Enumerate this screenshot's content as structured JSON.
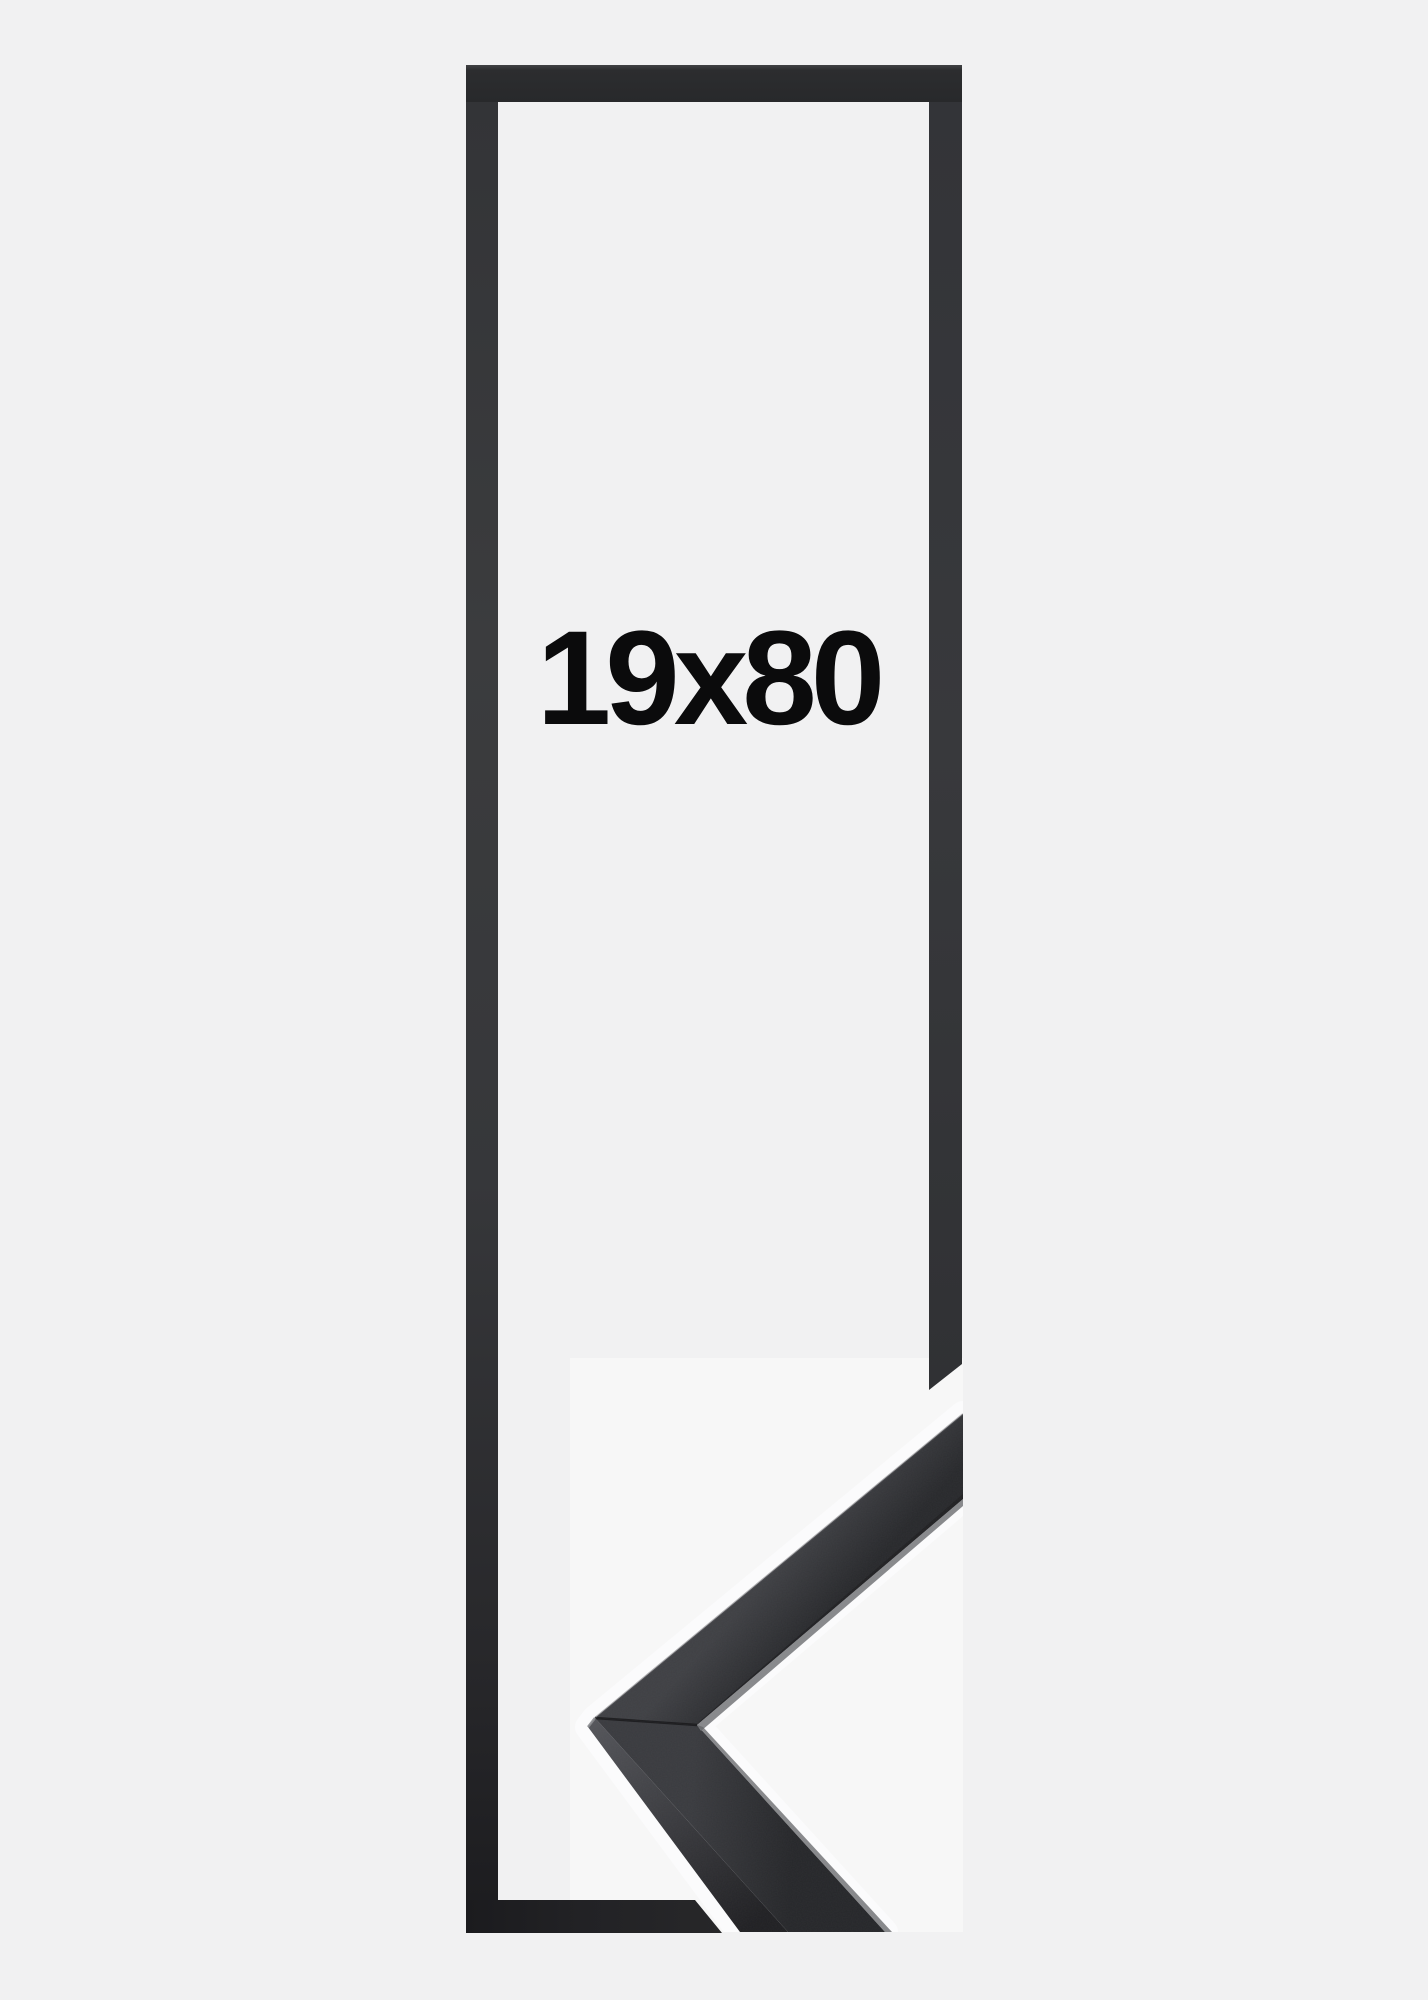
{
  "illustration": {
    "description": "Black picture frame size illustration with mitre corner sample",
    "size_label": "19x80"
  },
  "colors": {
    "background": "#f1f1f2",
    "label_text": "#0b0b0c",
    "outline_top_edge": "#414244",
    "outline_top_mid": "#2c2d2f",
    "outline_top_end": "#28292b",
    "outline_left_0": "#333437",
    "outline_left_1": "#3b3c3e",
    "outline_left_2": "#36373a",
    "outline_left_3": "#28282b",
    "outline_left_4": "#1d1d20",
    "outline_right_0": "#333438",
    "outline_right_1": "#38393c",
    "outline_right_2": "#303134",
    "outline_bottom_0": "#1b1b1e",
    "outline_bottom_1": "#222225",
    "outline_bottom_2": "#272729",
    "sample_backdrop": "rgba(255,255,255,0.42)",
    "halo": "#fbfbfc",
    "rail_upper_outer": "#3f4044",
    "rail_upper_inner": "#28292c",
    "rail_lower_outer": "#3a3b3f",
    "rail_lower_inner": "#26272a",
    "depth_near": "#54555a",
    "depth_far": "#202023",
    "edge_highlight": "#7b7c7f",
    "edge_highlight_soft": "#626366",
    "edge_shadow": "#1f1f22",
    "miter_seam": "#1a1a1c",
    "tip_highlight": "#8a8b8e",
    "outer_arris": "#56575b"
  }
}
